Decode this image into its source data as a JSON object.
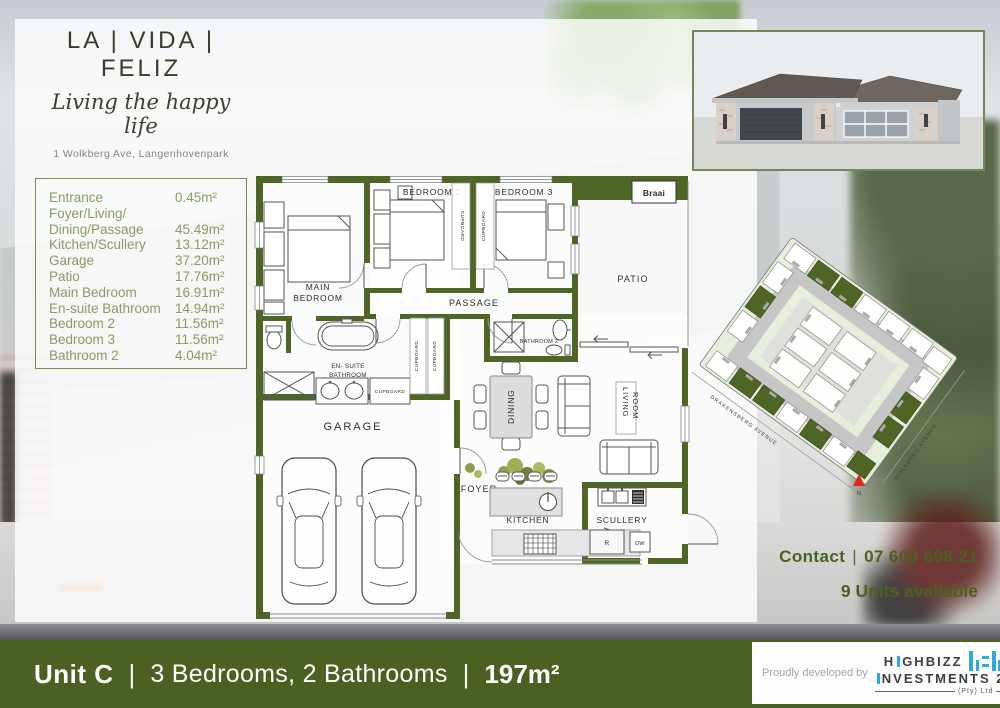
{
  "logo": {
    "title": "LA | VIDA | FELIZ",
    "tagline": "Living the happy life",
    "address": "1 Wolkberg Ave, Langenhovenpark"
  },
  "areas": {
    "rows": [
      {
        "label": "Entrance",
        "value": "0.45m²"
      },
      {
        "label": "Foyer/Living/",
        "label2": "Dining/Passage",
        "value": "45.49m²"
      },
      {
        "label": "Kitchen/Scullery",
        "value": "13.12m²"
      },
      {
        "label": "Garage",
        "value": "37.20m²"
      },
      {
        "label": "Patio",
        "value": "17.76m²"
      },
      {
        "label": "Main Bedroom",
        "value": "16.91m²"
      },
      {
        "label": "En-suite Bathroom",
        "value": "14.94m²"
      },
      {
        "label": "Bedroom 2",
        "value": "11.56m²"
      },
      {
        "label": "Bedroom 3",
        "value": "11.56m²"
      },
      {
        "label": "Bathroom 2",
        "value": "4.04m²"
      }
    ]
  },
  "floorplan": {
    "labels": {
      "main1": "MAIN",
      "main2": "BEDROOM",
      "bedroom2": "BEDROOM 2",
      "bedroom3": "BEDROOM 3",
      "cupboard": "CUPBOARD",
      "passage": "PASSAGE",
      "patio": "PATIO",
      "braai": "Braai",
      "bathroom2": "BATHROOM 2",
      "ensuite1": "EN- SUITE",
      "ensuite2": "BATHROOM",
      "garage": "GARAGE",
      "foyer": "FOYER",
      "dining": "DINING",
      "living1": "LIVING",
      "living2": "ROOM",
      "kitchen": "KITCHEN",
      "scullery": "SCULLERY",
      "fridge": "R",
      "dishwasher": "DW"
    }
  },
  "siteplan": {
    "street_left": "DRAKENSBERG AVENUE",
    "street_right": "WOLKBERG AVENUE",
    "north": "N"
  },
  "contact": {
    "prefix": "Contact",
    "separator": "|",
    "phone": "07 609 608 21",
    "availability": "9 Units available"
  },
  "banner": {
    "unit": "Unit C",
    "sep1": "|",
    "specs": "3 Bedrooms, 2 Bathrooms",
    "sep2": "|",
    "area": "197m²"
  },
  "developer": {
    "prefix": "Proudly developed by",
    "brand1a": "H",
    "brand1b": "GHBIZZ",
    "brand2": "NVESTMENTS 2",
    "pty": "(Pty) Ltd"
  },
  "colors": {
    "olive_wall": "#4f6526",
    "banner_green": "#4a6122",
    "table_text": "#8b9a62",
    "contact_text": "#4b6120",
    "brand_blue": "#29abe2"
  }
}
